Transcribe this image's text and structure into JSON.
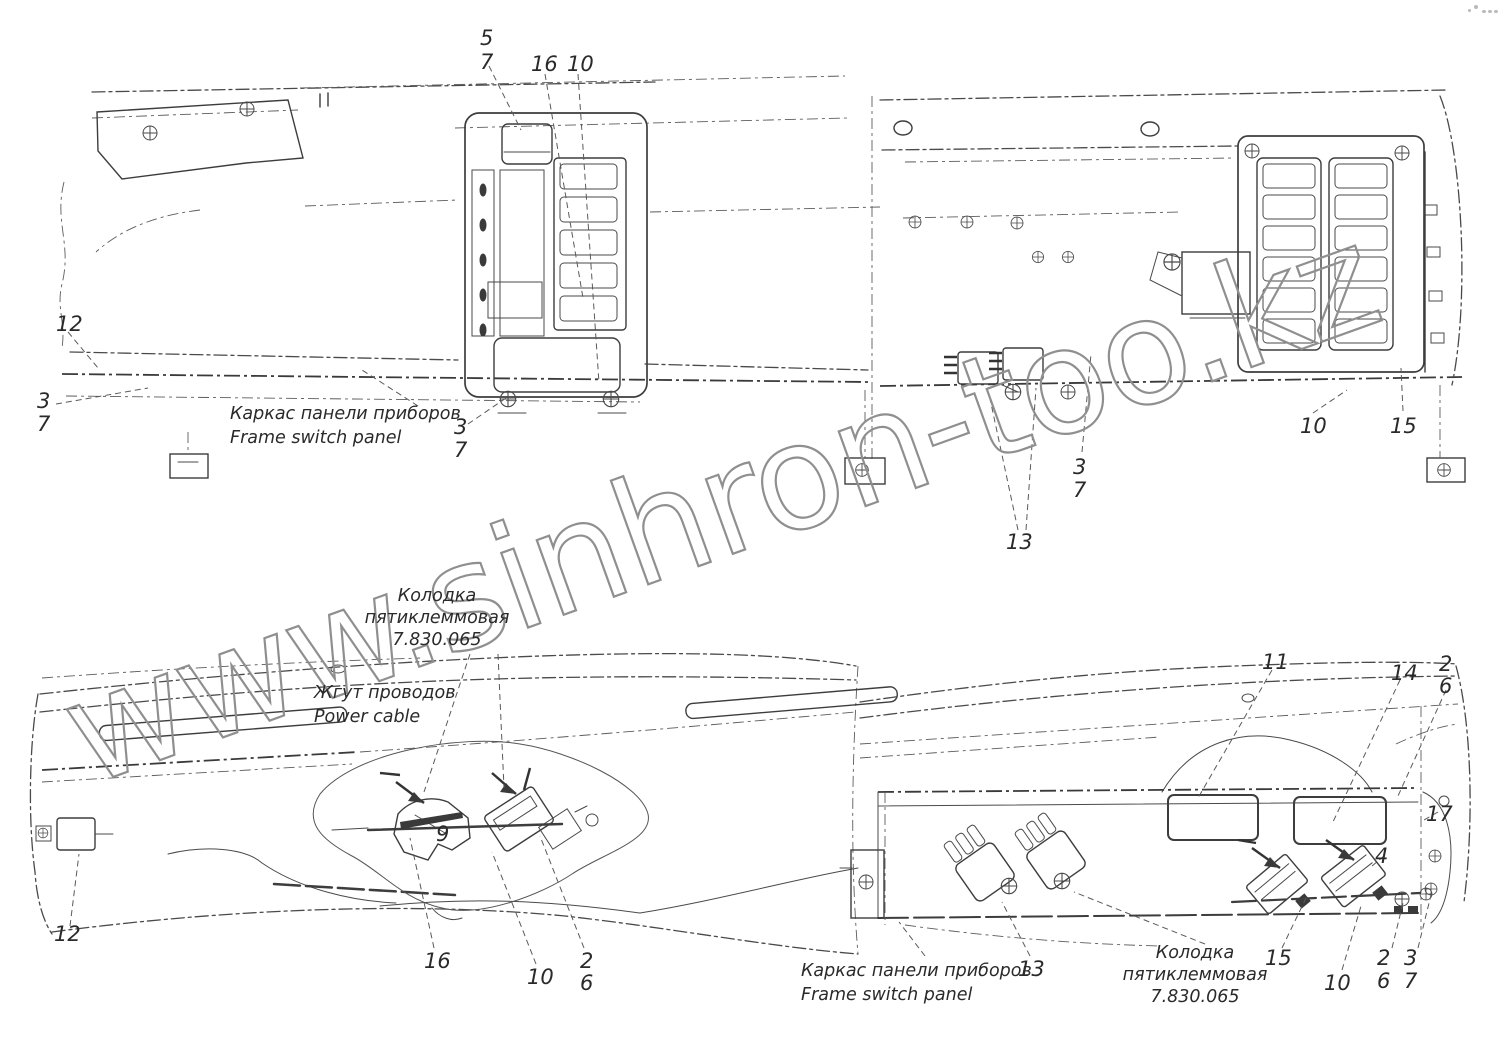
{
  "watermark": {
    "text": "www.sinhron-too.kz",
    "color": "#8f8f8f"
  },
  "line_color": "#3d3d3d",
  "annotations": {
    "frame_panel_top": {
      "ru": "Каркас панели приборов",
      "en": "Frame switch panel"
    },
    "frame_panel_bottom": {
      "ru": "Каркас панели приборов",
      "en": "Frame switch panel"
    },
    "connector_mid": {
      "l1": "Колодка",
      "l2": "пятиклеммовая",
      "l3": "7.830.065"
    },
    "connector_right": {
      "l1": "Колодка",
      "l2": "пятиклеммовая",
      "l3": "7.830.065"
    },
    "harness": {
      "ru": "Жгут проводов",
      "en": "Power cable"
    }
  },
  "callouts": [
    "5",
    "7",
    "16",
    "10",
    "12",
    "3",
    "7",
    "3",
    "7",
    "13",
    "3",
    "7",
    "10",
    "15",
    "12",
    "9",
    "16",
    "10",
    "2",
    "6",
    "11",
    "14",
    "2",
    "6",
    "17",
    "4",
    "13",
    "15",
    "10",
    "2",
    "6",
    "3",
    "7"
  ]
}
